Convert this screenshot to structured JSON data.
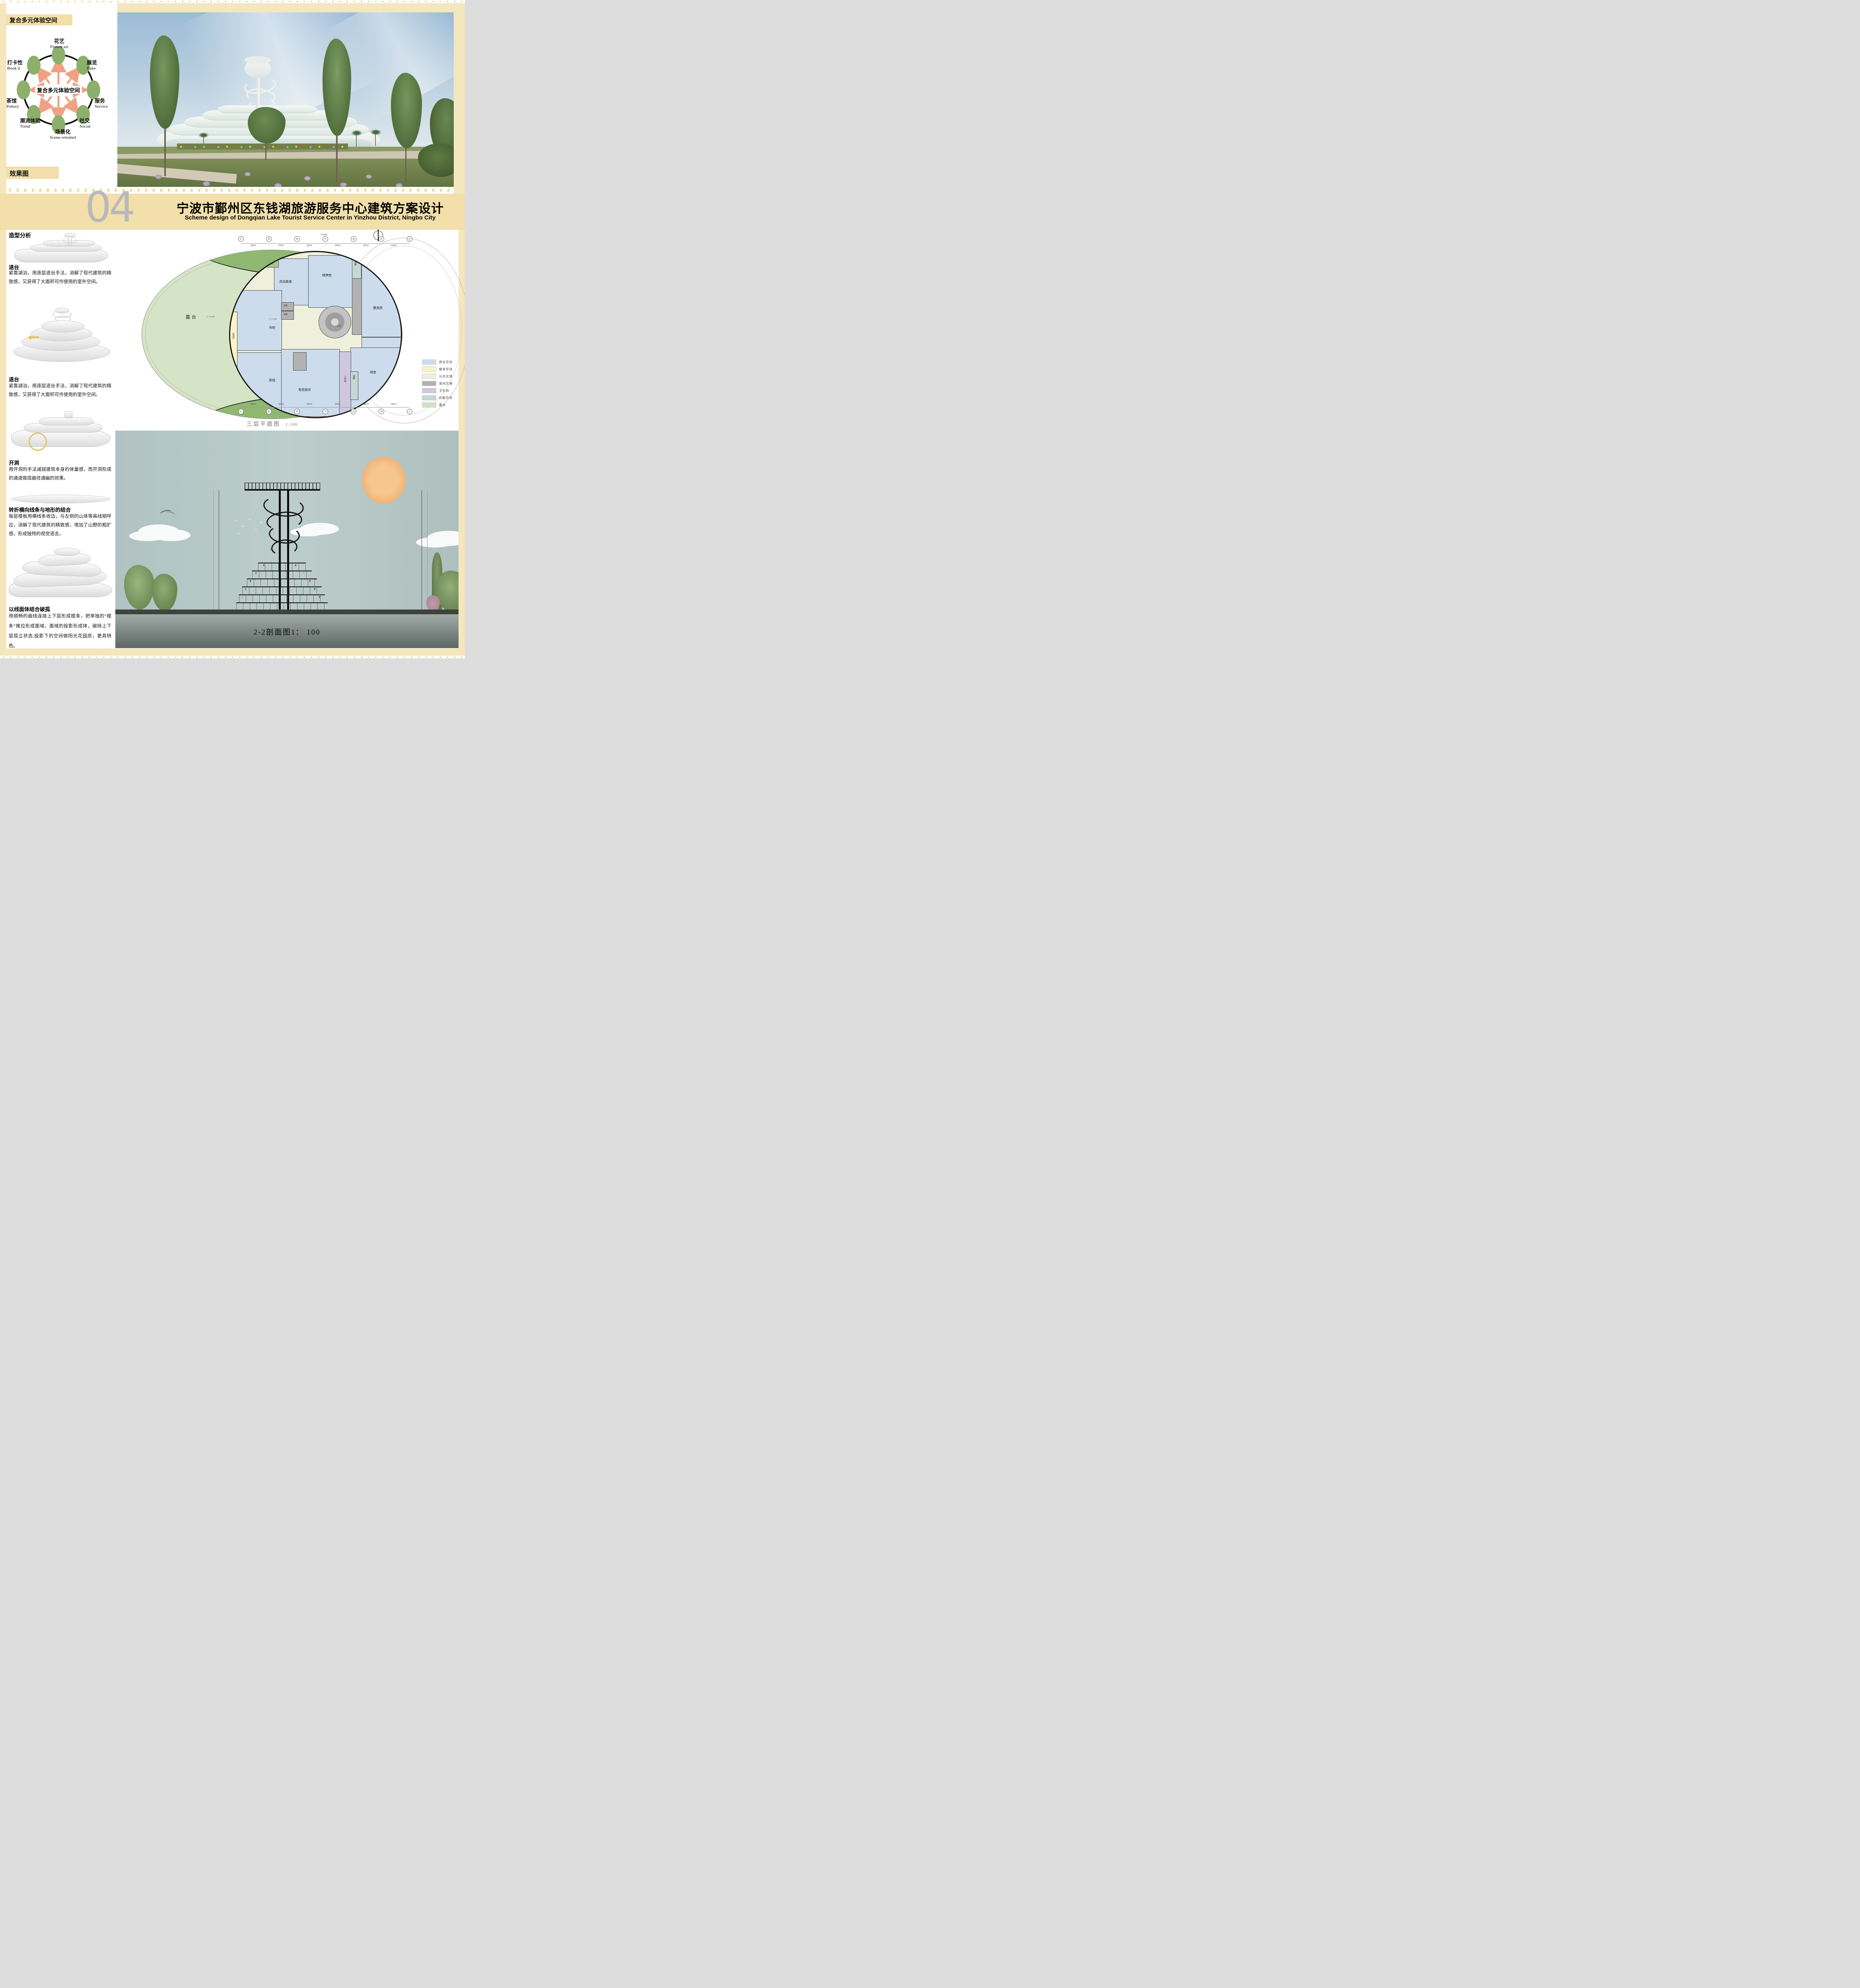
{
  "diagram": {
    "header": "复合多元体验空间",
    "center": "复合多元体验空间",
    "nodes": [
      {
        "cn": "花艺",
        "en": "Flower art"
      },
      {
        "cn": "展览",
        "en": "Bake"
      },
      {
        "cn": "服务",
        "en": "Service"
      },
      {
        "cn": "社交",
        "en": "Social"
      },
      {
        "cn": "场景化",
        "en": "Scene-oriented"
      },
      {
        "cn": "潮流体验",
        "en": "Trend"
      },
      {
        "cn": "茶馆",
        "en": "Pottery"
      },
      {
        "cn": "打卡性",
        "en": "Book it"
      }
    ]
  },
  "render": {
    "label": "效果图"
  },
  "header": {
    "number": "04",
    "title_cn": "宁波市鄞州区东钱湖旅游服务中心建筑方案设计",
    "title_en": "Scheme design of Dongqian Lake Tourist Service Center in Yinzhou District, Ningbo City"
  },
  "analysis": {
    "heading": "造型分析",
    "blocks": [
      {
        "title": "退台",
        "text": "紧靠湖泊，用逐层退台手法，消解了现代建筑的精致感，又获得了大面积可作使用的室外空间。"
      },
      {
        "title": "退台",
        "text": "紧靠湖泊，用逐层退台手法，消解了现代建筑的精致感，又获得了大面积可作使用的室外空间。"
      },
      {
        "title": "开洞",
        "text": "用开洞的手法减弱建筑本身的体量感，而开洞形成的通道做成曲径通幽的效果。"
      },
      {
        "title": "转折横向线条与地形的结合",
        "text": "每层楼板用横线条收边，与左侧的山体等高线相呼应，消解了现代建筑的精致感，增加了山野的粗犷感，形成独特的视觉语言。"
      },
      {
        "title": "以线面体结合破孤",
        "text": "用顺畅的曲线连接上下层形成檩条，把单独的“檩条”推拉形成面域，面域的投影形成体，破除上下层孤立状态,投影下的空间做阳光花园房，更具特色。"
      }
    ]
  },
  "floor_plan": {
    "caption": "三层平面图",
    "scale": "1:100",
    "terrace": "露台",
    "void": "上空",
    "level": "12.400",
    "grid": {
      "letters": [
        "C",
        "D",
        "E",
        "F",
        "G",
        "H",
        "J"
      ],
      "bay": "9600",
      "total": "57600"
    },
    "rooms": {
      "book_bar": "书吧",
      "tea_house": "茶馆",
      "bath_sauna": "洗浴桑拿",
      "chess_room": "棋牌室",
      "gym": "健身房",
      "ktv": "歌舞酒厅",
      "esports": "电竞娱乐",
      "ball_room": "球室",
      "toilet": "卫生间",
      "storage": "储藏",
      "garden": "花园",
      "lounge": "休闲厅",
      "equipment": "设备"
    },
    "legend": [
      {
        "label": "商业空间",
        "color": "#ccdcec"
      },
      {
        "label": "服务空间",
        "color": "#faf3c6"
      },
      {
        "label": "公共交通",
        "color": "#eef0dc"
      },
      {
        "label": "竖向交通",
        "color": "#b2b2b2"
      },
      {
        "label": "卫生间",
        "color": "#cfc6e0"
      },
      {
        "label": "后勤空间",
        "color": "#c4d8d6"
      },
      {
        "label": "露台",
        "color": "#cfe3c2"
      }
    ]
  },
  "section": {
    "caption": "2-2剖面图1： 100"
  }
}
